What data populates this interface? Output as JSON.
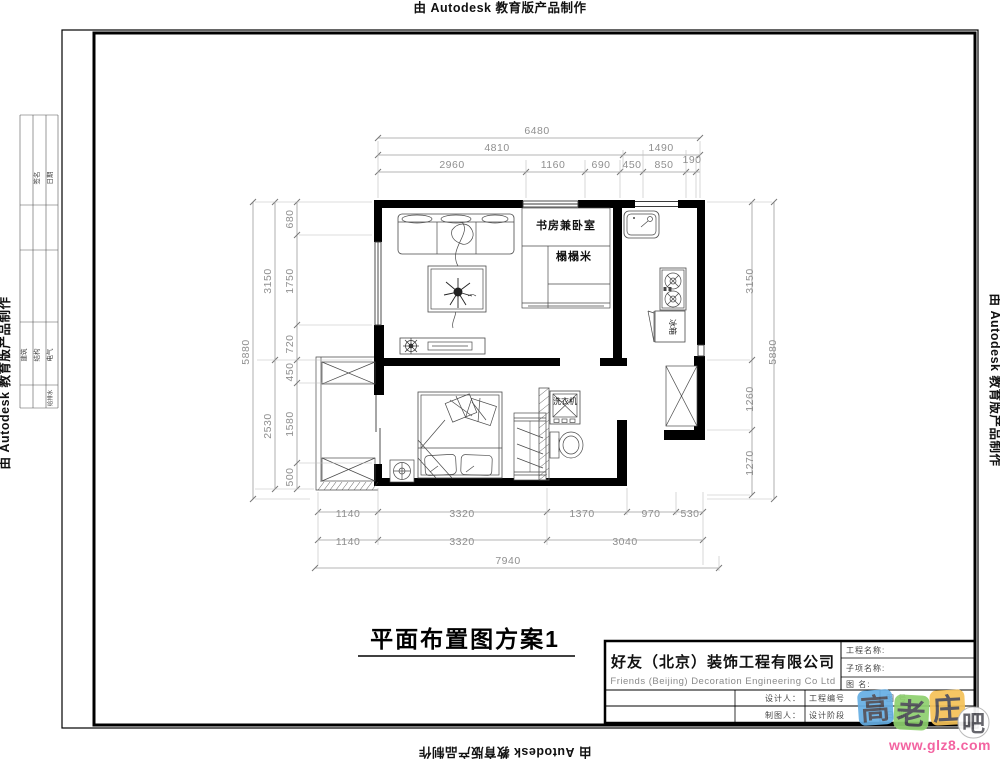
{
  "banner": {
    "text": "由 Autodesk 教育版产品制作"
  },
  "drawing_title": "平面布置图方案1",
  "plan": {
    "room_labels": {
      "study_bedroom": "书房兼卧室",
      "tatami": "榻榻米",
      "washer": "洗衣机",
      "fridge_cabinet": "冰箱"
    },
    "dims": {
      "top": [
        "6480",
        "4810",
        "1490",
        "2960",
        "1160",
        "690",
        "450",
        "850",
        "190"
      ],
      "left": [
        "5880",
        "3150",
        "2530",
        "680",
        "1750",
        "720",
        "450",
        "1580",
        "500"
      ],
      "right": [
        "3150",
        "1260",
        "1270",
        "5880"
      ],
      "bottom": [
        "1140",
        "3320",
        "1370",
        "970",
        "530",
        "1140",
        "3320",
        "3040",
        "7940"
      ]
    }
  },
  "signoff_strip": {
    "top_labels": [
      "签名",
      "日期"
    ],
    "disciplines": [
      "建筑",
      "结构",
      "电气",
      "给排水"
    ]
  },
  "title_block": {
    "company_cn": "好友（北京）装饰工程有限公司",
    "company_en": "Friends (Beijing) Decoration Engineering Co Ltd",
    "fields": {
      "project": "工程名称:",
      "subitem": "子项名称:",
      "drawing": "图  名:",
      "designer": "设计人：",
      "drafter": "制图人：",
      "project_no": "工程编号",
      "stage": "设计阶段",
      "drawing_no": "图  号",
      "date": "日 期"
    }
  },
  "watermark": {
    "chars": [
      "高",
      "老",
      "庄",
      "吧"
    ],
    "url": "www.glz8.com",
    "tile_colors": [
      "#66aee3",
      "#8ed06e",
      "#f5c257",
      "#ffffff"
    ],
    "url_color": "#f2579a"
  }
}
